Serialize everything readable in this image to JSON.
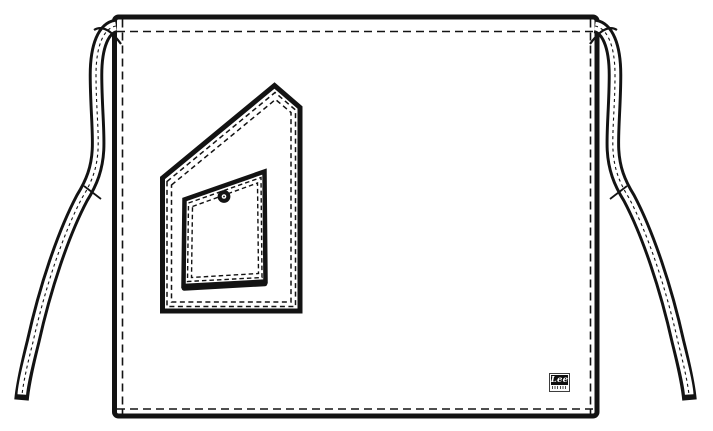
{
  "artwork": {
    "brand_label": {
      "text": "Lee"
    }
  },
  "colors": {
    "ink": "#131313",
    "paper": "#ffffff"
  }
}
